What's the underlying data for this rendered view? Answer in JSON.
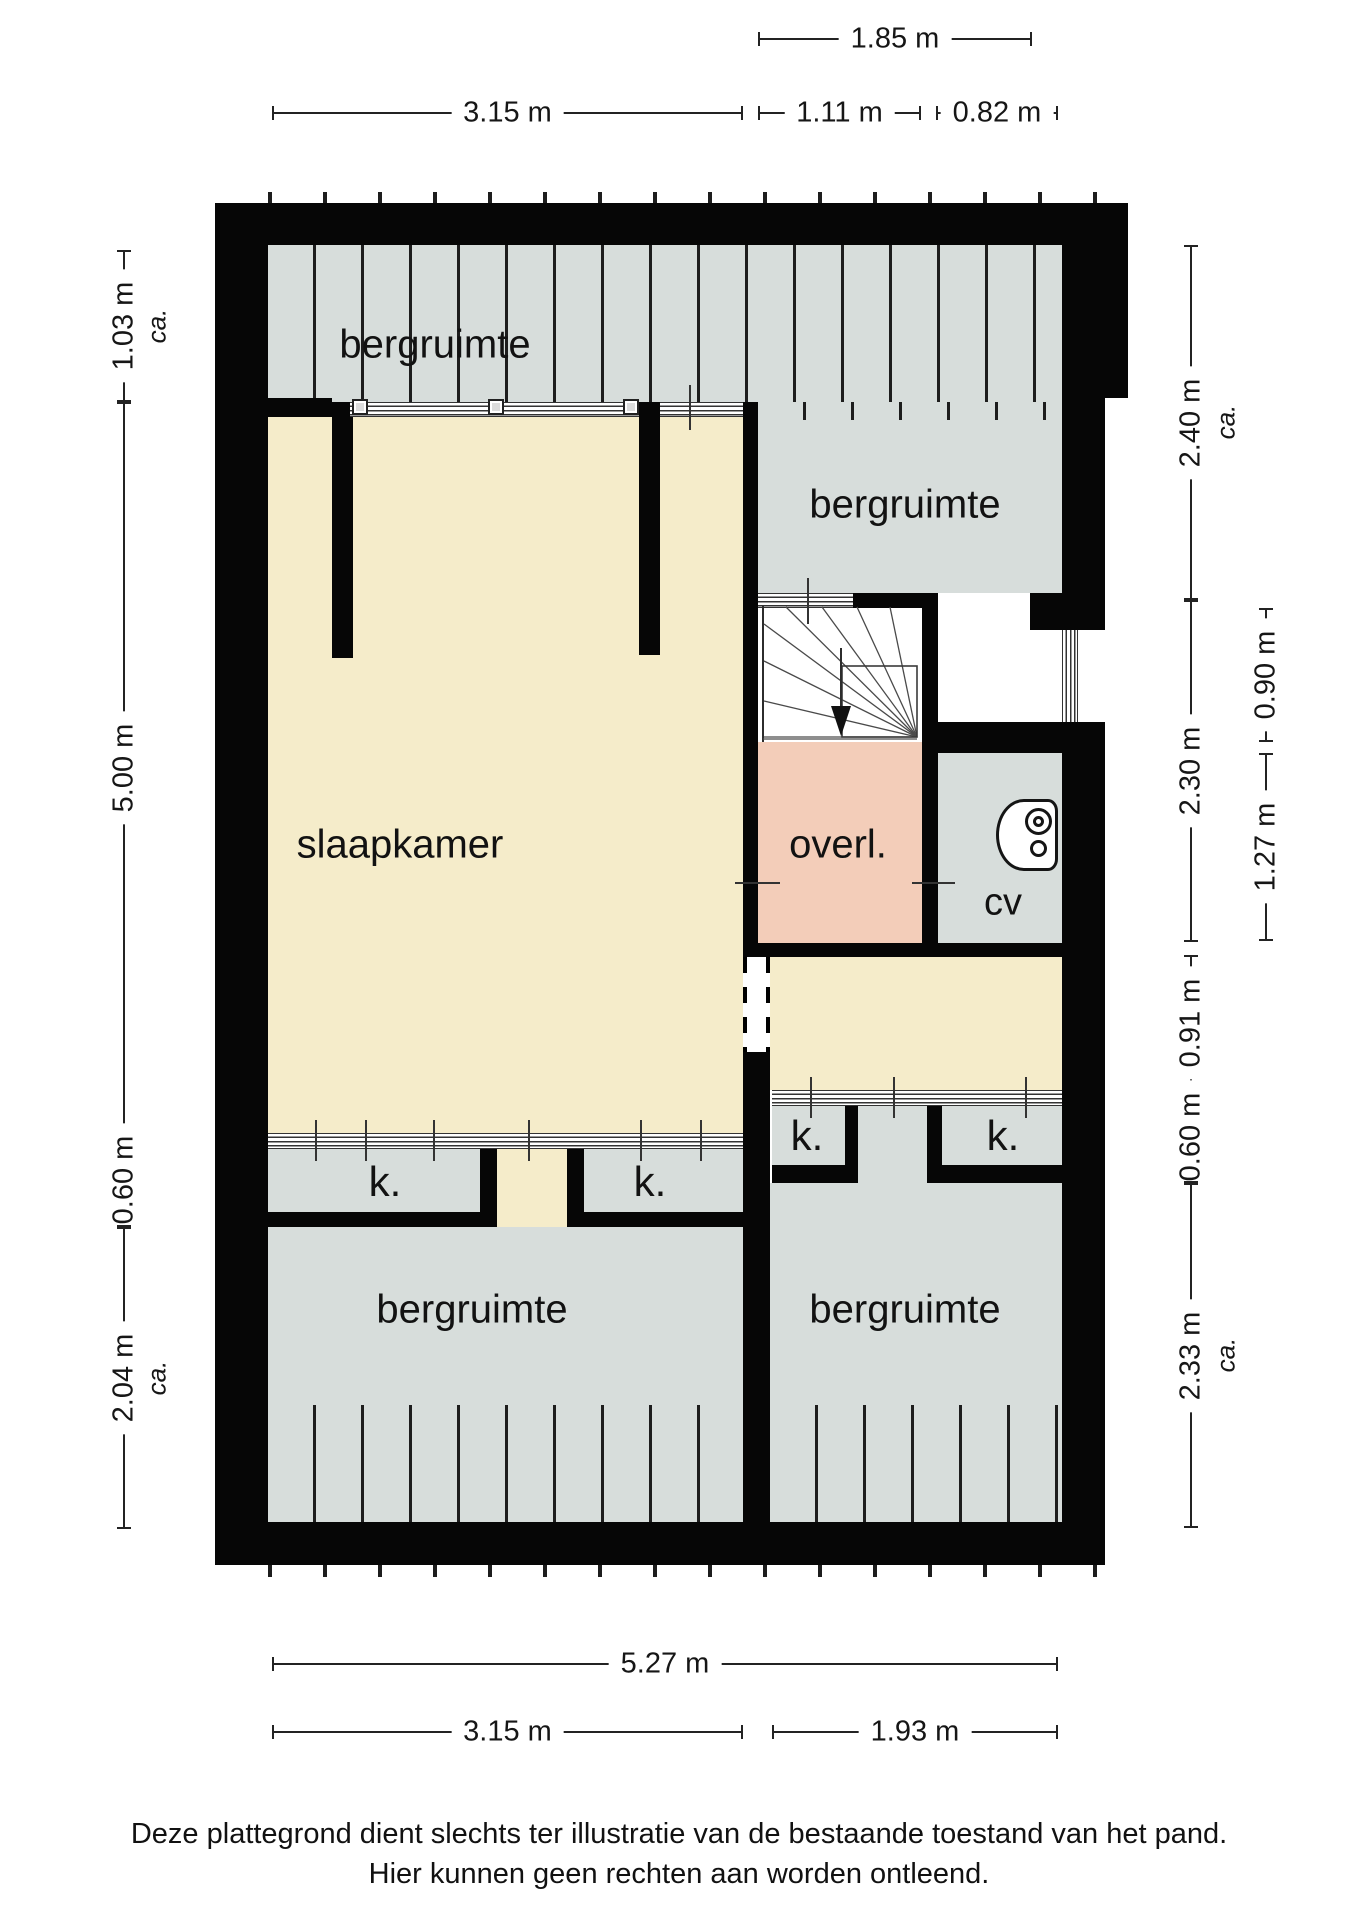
{
  "rooms": {
    "bergruimte_top_left": "bergruimte",
    "bergruimte_top_right": "bergruimte",
    "slaapkamer": "slaapkamer",
    "overloop": "overl.",
    "cv": "cv",
    "kast_left_a": "k.",
    "kast_left_b": "k.",
    "kast_right_a": "k.",
    "kast_right_b": "k.",
    "bergruimte_bottom_left": "bergruimte",
    "bergruimte_bottom_right": "bergruimte"
  },
  "dimensions": {
    "top": [
      "1.85 m"
    ],
    "top2": [
      "3.15 m",
      "1.11 m",
      "0.82 m"
    ],
    "left": [
      "1.03 m",
      "5.00 m",
      "0.60 m",
      "2.04 m"
    ],
    "right_inner": [
      "2.40 m",
      "2.30 m",
      "0.91 m",
      "0.60 m",
      "2.33 m"
    ],
    "right_outer": [
      "0.90 m",
      "1.27 m"
    ],
    "bottom": [
      "5.27 m"
    ],
    "bottom2": [
      "3.15 m",
      "1.93 m"
    ],
    "approx_label": "ca."
  },
  "disclaimer": {
    "line1": "Deze plattegrond dient slechts ter illustratie van de bestaande toestand van het pand.",
    "line2": "Hier kunnen geen rechten aan worden ontleend."
  },
  "colors": {
    "wall": "#060606",
    "cream": "#f5ecca",
    "grey": "#d7dddb",
    "salmon": "#f3cdb9",
    "hatch": "#1d1d1d",
    "dim": "#232323",
    "text": "#111111"
  }
}
